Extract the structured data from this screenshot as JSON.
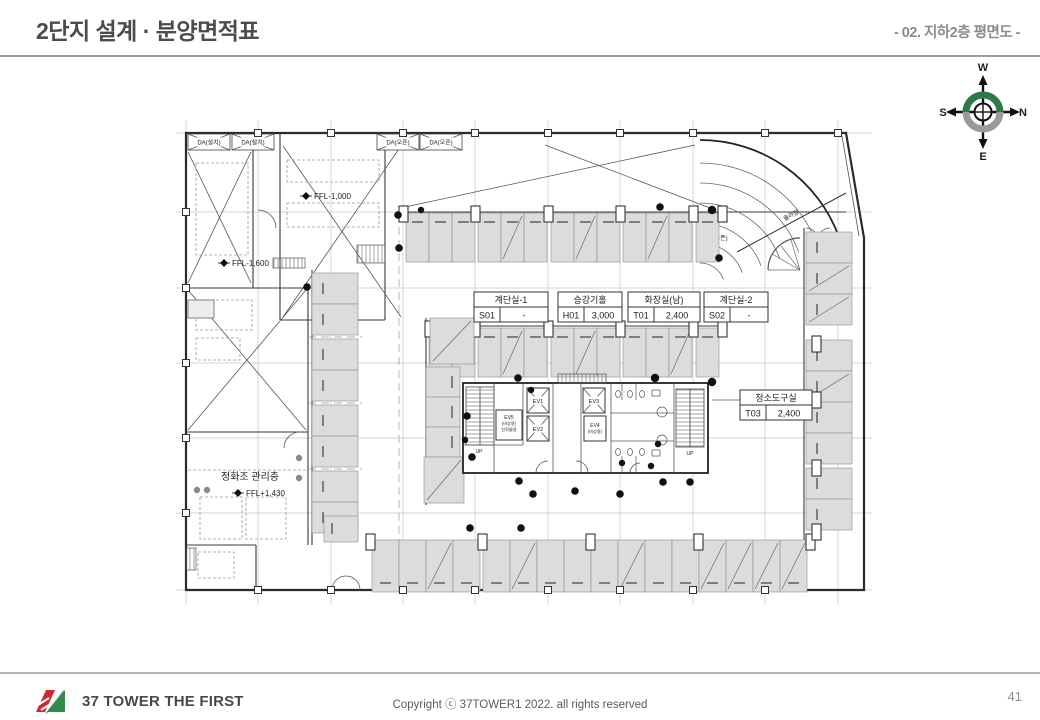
{
  "header": {
    "title": "2단지 설계 · 분양면적표",
    "subtitle": "- 02. 지하2층 평면도 -"
  },
  "compass": {
    "north": "N",
    "south": "S",
    "east": "E",
    "west": "W"
  },
  "colors": {
    "compass_green": "#2c7a4b",
    "compass_gray": "#9a9a9a",
    "logo_red": "#cf2630",
    "logo_green": "#2e8b4a"
  },
  "plan": {
    "room_labels": [
      {
        "name": "계단실-1",
        "code": "S01",
        "value": "-"
      },
      {
        "name": "승강기홀",
        "code": "H01",
        "value": "3,000"
      },
      {
        "name": "화장실(남)",
        "code": "T01",
        "value": "2,400"
      },
      {
        "name": "계단실-2",
        "code": "S02",
        "value": "-"
      },
      {
        "name": "청소도구실",
        "code": "T03",
        "value": "2,400"
      }
    ],
    "vents": [
      {
        "label": "DA(설치)"
      },
      {
        "label": "DA(설치)"
      },
      {
        "label": "DA(오픈)"
      },
      {
        "label": "DA(오픈)"
      }
    ],
    "annotations": {
      "ffl_top": "FFL-1,000",
      "ffl_left": "FFL-1,600",
      "ffl_bottom": "FFL+1,430",
      "septic_room": "정화조 관리층",
      "ramp_up": "올라감",
      "da_open": "DA(오픈)"
    },
    "core": {
      "ev1": "EV1",
      "ev2": "EV2",
      "ev3": "EV3",
      "ev4": "EV4",
      "ev4_sub": "(비상용)",
      "ev5": "EV5",
      "ev5_sub": "(비상용)",
      "ev5_sub2": "인화물용",
      "up_left": "UP",
      "up_right": "UP"
    }
  },
  "footer": {
    "brand": "37 TOWER THE FIRST",
    "copyright": "Copyright ⓒ 37TOWER1 2022. all rights reserved",
    "page": "41"
  }
}
